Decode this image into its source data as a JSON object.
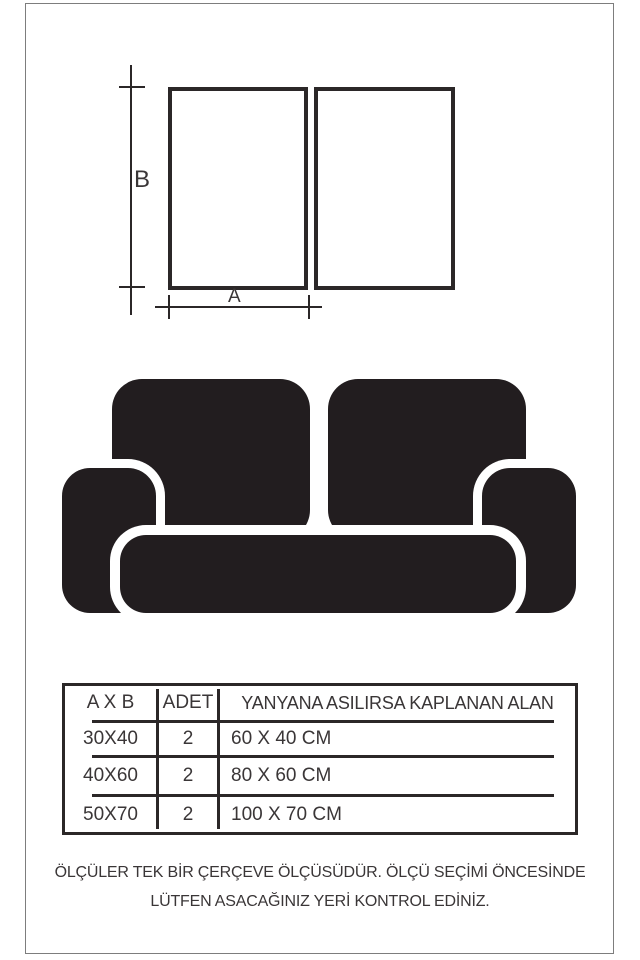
{
  "diagram": {
    "width_label": "A",
    "height_label": "B"
  },
  "size_table": {
    "headers": [
      "A X B",
      "ADET",
      "YANYANA ASILIRSA KAPLANAN ALAN"
    ],
    "rows": [
      [
        "30X40",
        "2",
        "60 X 40 CM"
      ],
      [
        "40X60",
        "2",
        "80 X 60 CM"
      ],
      [
        "50X70",
        "2",
        "100 X 70 CM"
      ]
    ]
  },
  "footer": {
    "line1": "ÖLÇÜLER TEK BİR ÇERÇEVE ÖLÇÜSÜDÜR. ÖLÇÜ SEÇİMİ ÖNCESİNDE",
    "line2": "LÜTFEN ASACAĞINIZ YERİ KONTROL EDİNİZ."
  },
  "colors": {
    "line": "#2b2728",
    "text": "#3a3637",
    "sofa": "#221d1f",
    "frame_border": "#7d7d7d"
  }
}
